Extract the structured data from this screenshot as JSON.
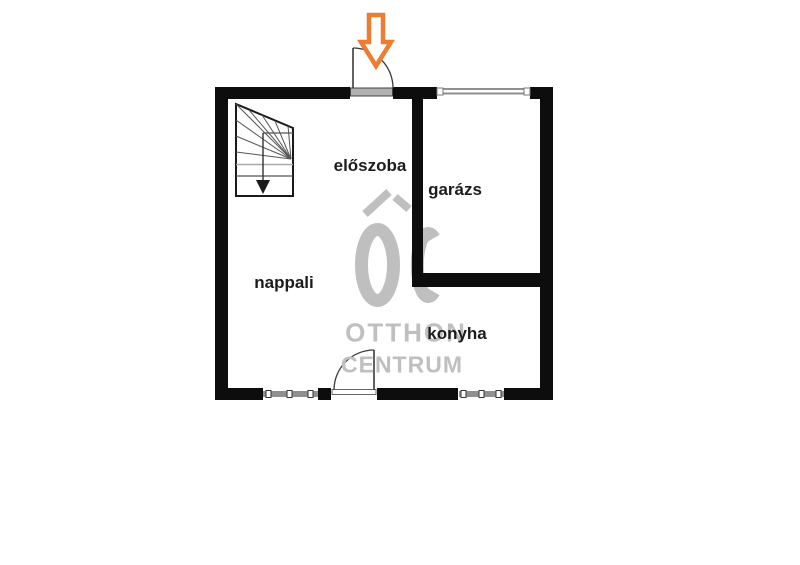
{
  "page": {
    "background_color": "#ffffff"
  },
  "floor_plan": {
    "rooms": [
      {
        "id": "eloszoba",
        "label": "előszoba"
      },
      {
        "id": "garazs",
        "label": "garázs"
      },
      {
        "id": "nappali",
        "label": "nappali"
      },
      {
        "id": "konyha",
        "label": "konyha"
      }
    ],
    "colors": {
      "wall": "#0d0d0d",
      "window": "#8f8f8f",
      "door_line": "#3a3a3a",
      "arrow": "#ED7D31",
      "label_text": "#1c1c1c",
      "watermark": "#bfbfbf"
    },
    "icons": [
      "entrance-arrow-down-icon",
      "staircase-icon",
      "door-swing-icon",
      "window-icon",
      "otthon-centrum-logo-icon"
    ]
  },
  "watermark": {
    "line1": "OTTHON",
    "line2": "CENTRUM"
  }
}
